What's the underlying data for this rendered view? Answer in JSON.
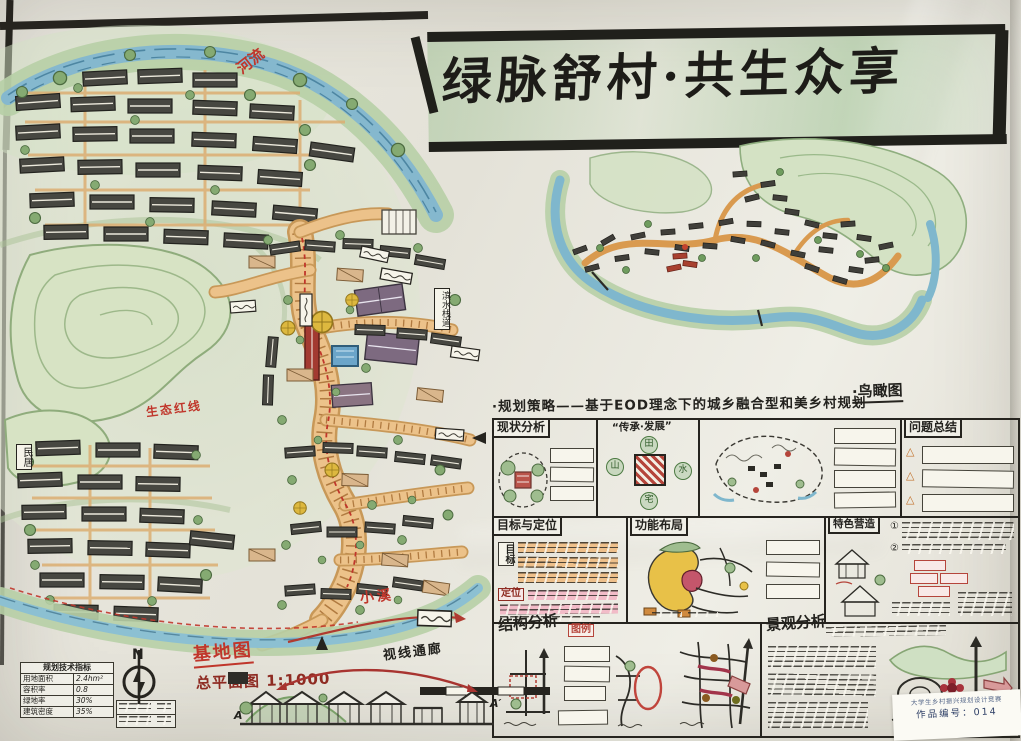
{
  "photo": {
    "board_title": "绿脉舒村·共生众享",
    "sticker_line1": "大学生乡村振兴规划设计竞赛",
    "sticker_line2": "作品编号：014"
  },
  "masterplan": {
    "river_label": "河流",
    "eco_line_label": "生态红线",
    "stream_label": "小溪",
    "boardwalk_label": "滨水栈道",
    "residence_label": "民居",
    "north_letter": "N",
    "plan_tag": "基地图",
    "plan_scale_label": "总平面图 1:1000",
    "sight_corridor_label": "视线通廊",
    "section_left": "A",
    "section_right": "A′"
  },
  "indicators": {
    "header": "规划技术指标",
    "rows": [
      {
        "label": "用地面积",
        "value": "2.4hm²"
      },
      {
        "label": "容积率",
        "value": "0.8"
      },
      {
        "label": "绿地率",
        "value": "30%"
      },
      {
        "label": "建筑密度",
        "value": "35%"
      }
    ]
  },
  "birdseye": {
    "label": "·鸟瞰图"
  },
  "analysis": {
    "header": "·规划策略——基于EOD理念下的城乡融合型和美乡村规划",
    "status_title": "现状分析",
    "status_quote": "“传承·发展”",
    "elem_mountain": "山",
    "elem_field": "田",
    "elem_house": "宅",
    "elem_water": "水",
    "problem_title": "问题总结",
    "warn_mark": "△",
    "goal_title": "目标与定位",
    "goal_tag": "目标",
    "position_tag": "定位",
    "function_title": "功能布局",
    "feature_title": "特色营造",
    "num1": "①",
    "num2": "②",
    "structure_title": "结构分析",
    "legend_tag": "图例",
    "landscape_title": "景观分析"
  }
}
